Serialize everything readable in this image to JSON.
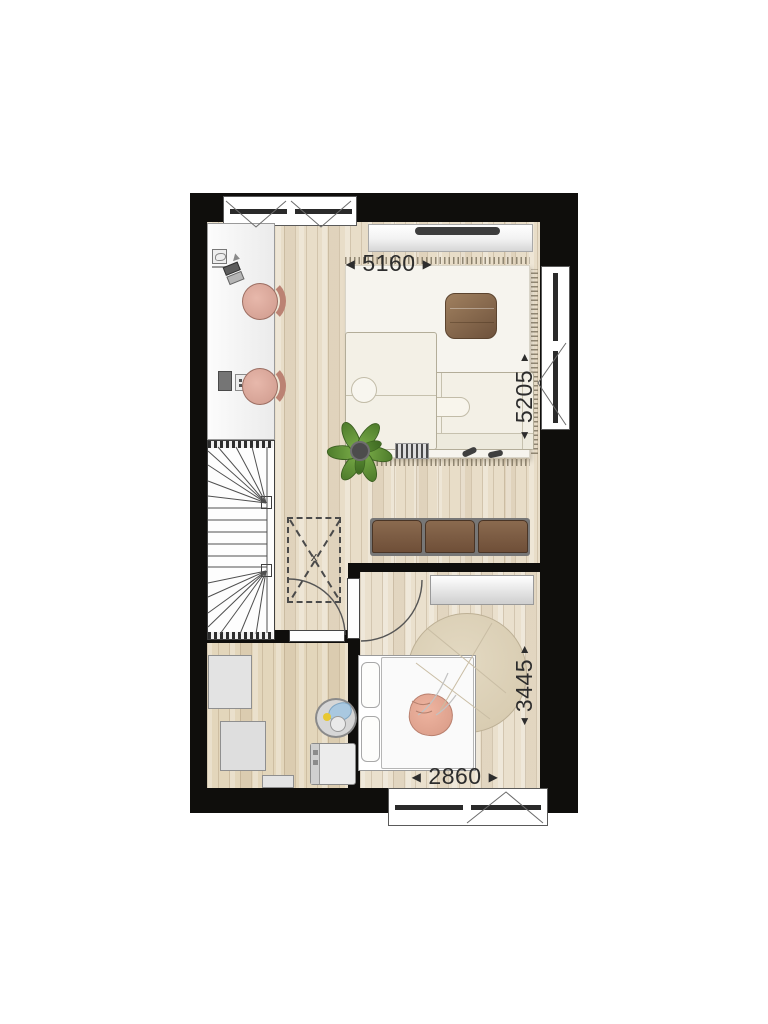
{
  "plan": {
    "dimensions": {
      "top": {
        "value": "5160",
        "left_arrow": "◀",
        "right_arrow": "▶"
      },
      "right": {
        "value": "5205",
        "up_arrow": "▲",
        "down_arrow": "▼"
      },
      "bedroom_right": {
        "value": "3445",
        "up_arrow": "▲",
        "down_arrow": "▼"
      },
      "bedroom_bottom": {
        "value": "2860",
        "left_arrow": "◀",
        "right_arrow": "▶"
      }
    },
    "symbols": {
      "shaft_marker": "x"
    },
    "colors": {
      "wall": "#0f0e0c",
      "floor_living": "#e8ddc8",
      "floor_laundry": "#e3d6bb",
      "floor_bedroom": "#eae0cd",
      "rug": "#f6f4ee",
      "sofa": "#f3f0e6",
      "pouf_brown": "#8a6b50",
      "bench_brown": "#7c5a41",
      "chair_pink": "#dcab9e",
      "plant_green": "#679339",
      "bed_pillow_pink": "#e2a18d",
      "laundry_blue": "#a9c8e0"
    },
    "icons": {
      "sofa": "css-shape",
      "tv": "css-shape",
      "plant": "css-shape",
      "stairs": "css-shape",
      "bed": "css-shape",
      "washing_machine": "css-shape",
      "desk_chairs": "css-shape",
      "laundry_basket": "css-shape"
    }
  }
}
